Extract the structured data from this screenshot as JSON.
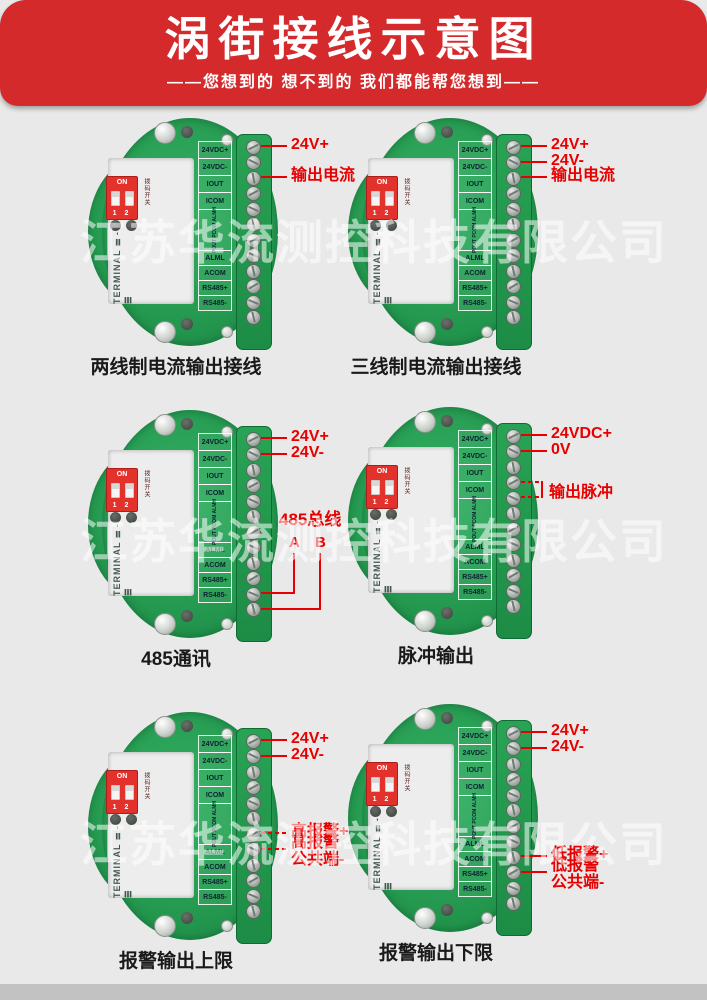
{
  "header": {
    "title": "涡街接线示意图",
    "subtitle": "——您想到的  想不到的  我们都能帮您想到——"
  },
  "watermark": {
    "text": "江苏华流测控科技有限公司"
  },
  "board_common": {
    "dip_on": "ON",
    "dip_numbers": "1 2",
    "dip_side_label": "拨码开关",
    "silkscreen": "TERMINAL Ⅱ-Ⅲ",
    "terminal_labels_top": [
      "24VDC+",
      "24VDC-",
      "IOUT",
      "ICOM"
    ],
    "terminal_labels_vertical": "POUT PCOM ALMH",
    "terminal_labels_bottom": [
      "ALML",
      "ACOM",
      "RS485+",
      "RS485-"
    ]
  },
  "colors": {
    "header_red": "#d42a2c",
    "annotation_red": "#e80000",
    "pcb_green": "#259a50",
    "terminal_green": "#1d8c46",
    "background_grey": "#e9e9e9",
    "footer_grey": "#c2c2c2"
  },
  "boards": [
    {
      "caption": "两线制电流输出接线",
      "annotations": [
        {
          "lines": [
            "24V+"
          ],
          "row": 1,
          "style": "solid"
        },
        {
          "lines": [
            "输出电流"
          ],
          "row": 3,
          "style": "solid"
        }
      ]
    },
    {
      "caption": "三线制电流输出接线",
      "annotations": [
        {
          "lines": [
            "24V+"
          ],
          "row": 1,
          "style": "solid"
        },
        {
          "lines": [
            "24V-"
          ],
          "row": 2,
          "style": "solid"
        },
        {
          "lines": [
            "输出电流"
          ],
          "row": 3,
          "style": "solid"
        }
      ]
    },
    {
      "caption": "485通讯",
      "annotations": [
        {
          "lines": [
            "24V+"
          ],
          "row": 1,
          "style": "solid"
        },
        {
          "lines": [
            "24V-"
          ],
          "row": 2,
          "style": "solid"
        }
      ],
      "bus": {
        "title": "485总线",
        "wire_a": "A",
        "wire_b": "B",
        "row_a": 11,
        "row_b": 12
      }
    },
    {
      "caption": "脉冲输出",
      "annotations": [
        {
          "lines": [
            "24VDC+"
          ],
          "row": 1,
          "style": "solid"
        },
        {
          "lines": [
            "0V"
          ],
          "row": 2,
          "style": "solid"
        }
      ],
      "bracket": {
        "label": "输出脉冲",
        "rows": [
          4,
          5
        ]
      }
    },
    {
      "caption": "报警输出上限",
      "annotations": [
        {
          "lines": [
            "24V+"
          ],
          "row": 1,
          "style": "solid"
        },
        {
          "lines": [
            "24V-"
          ],
          "row": 2,
          "style": "solid"
        },
        {
          "lines": [
            "高报警+"
          ],
          "row": 7,
          "style": "dashed"
        },
        {
          "lines": [
            "高报警",
            "公共端-"
          ],
          "row": 8,
          "style": "dashed"
        }
      ]
    },
    {
      "caption": "报警输出下限",
      "annotations": [
        {
          "lines": [
            "24V+"
          ],
          "row": 1,
          "style": "solid"
        },
        {
          "lines": [
            "24V-"
          ],
          "row": 2,
          "style": "solid"
        },
        {
          "lines": [
            "低报警+"
          ],
          "row": 9,
          "style": "solid"
        },
        {
          "lines": [
            "低报警",
            "公共端-"
          ],
          "row": 10,
          "style": "solid"
        }
      ]
    }
  ]
}
